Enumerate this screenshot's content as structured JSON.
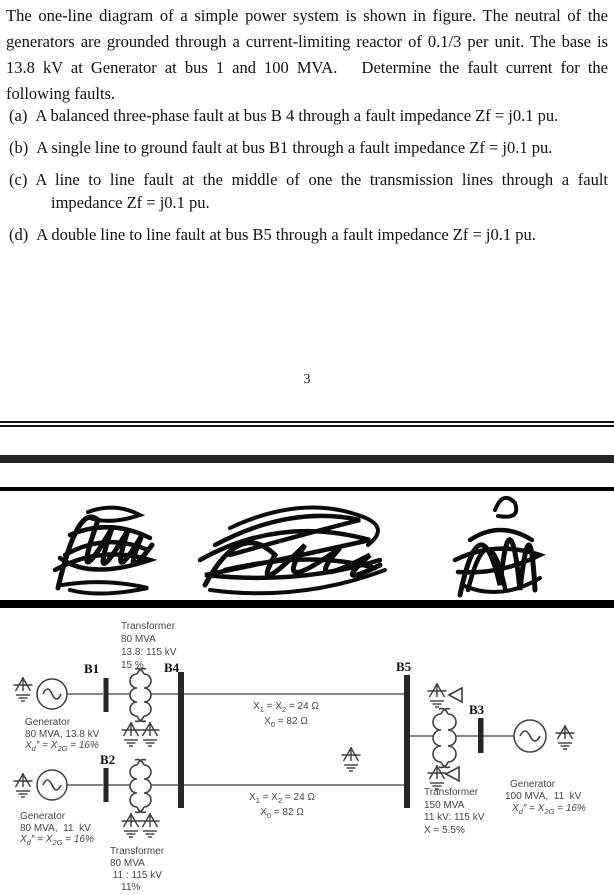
{
  "problem": {
    "intro": "The one-line diagram of a simple power system is shown in figure. The neutral of the generators are grounded through a current-limiting reactor of 0.1/3 per unit. The base is 13.8 kV at Generator at bus 1 and 100 MVA.   Determine the fault current for the following faults.",
    "items": [
      {
        "label": "(a)",
        "text": "A balanced three-phase fault at bus B 4 through a fault impedance Zf = j0.1 pu."
      },
      {
        "label": "(b)",
        "text": "A single line to ground fault at bus B1 through a fault impedance Zf = j0.1 pu."
      },
      {
        "label": "(c)",
        "text": "A line to line fault at the middle of one the transmission lines through a fault impedance Zf = j0.1 pu."
      },
      {
        "label": "(d)",
        "text": "A double line to line fault at bus B5 through a fault impedance Zf = j0.1 pu."
      }
    ],
    "page_number": "3"
  },
  "diagram": {
    "buses": {
      "b1": "B1",
      "b2": "B2",
      "b3": "B3",
      "b4": "B4",
      "b5": "B5"
    },
    "generator1": {
      "name": "Generator",
      "rating": "80 MVA, 13.8 kV",
      "reactance_html": "<i>X</i><sub>d</sub>″ = <i>X</i><sub>2G</sub> = 16%"
    },
    "generator2": {
      "name": "Generator",
      "rating": "80 MVA,  11  kV",
      "reactance_html": "<i>X</i><sub>d</sub>″ = <i>X</i><sub>2G</sub> = 16%"
    },
    "generator3": {
      "name": "Generator",
      "rating": "100 MVA,  11  kV",
      "reactance_html": "<i>X</i><sub>d</sub>″ = <i>X</i><sub>2G</sub> = 16%"
    },
    "transformer1": {
      "name": "Transformer",
      "rating": "80 MVA",
      "voltage": "13.8: 115 kV",
      "impedance": "15 %"
    },
    "transformer2": {
      "name": "Transformer",
      "rating": "80 MVA",
      "voltage": " 11 : 115 kV",
      "impedance": "11%"
    },
    "transformer3": {
      "name": "Transformer",
      "rating": "150 MVA",
      "voltage": "11 kV: 115 kV",
      "impedance": "X = 5.5%"
    },
    "line_top": {
      "x12_html": "X<sub>1</sub> = X<sub>2</sub> = 24 Ω",
      "x0_html": "X<sub>0</sub> = 82 Ω"
    },
    "line_bottom": {
      "x12_html": "X<sub>1</sub> = X<sub>2</sub> = 24 Ω",
      "x0_html": "X<sub>0</sub> = 82 Ω"
    },
    "icons": {
      "ground": "earth-ground-symbol",
      "generator": "ac-source-circle-with-sine",
      "transformer": "two-winding-coils",
      "delta": "delta-winding-triangle",
      "bus": "solid-vertical-bar"
    },
    "colors": {
      "stroke": "#3f3f3f",
      "bus": "#262626",
      "label": "#474747",
      "ink": "#0c0c0c"
    }
  }
}
